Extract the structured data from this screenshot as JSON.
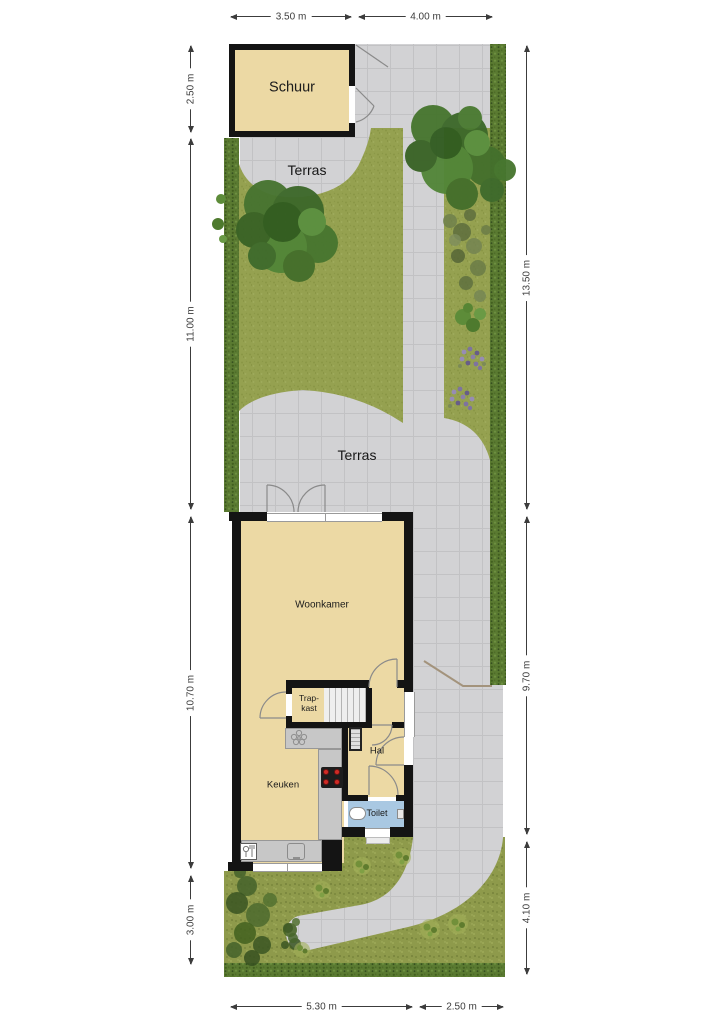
{
  "plan": {
    "labels": {
      "schuur": "Schuur",
      "terras_top": "Terras",
      "terras_mid": "Terras",
      "woonkamer": "Woonkamer",
      "trapkast_line1": "Trap-",
      "trapkast_line2": "kast",
      "keuken": "Keuken",
      "hal": "Hal",
      "toilet": "Toilet"
    },
    "dimensions": {
      "top": [
        "3.50 m",
        "4.00 m"
      ],
      "left": [
        "2.50 m",
        "11.00 m",
        "10.70 m",
        "3.00 m"
      ],
      "right": [
        "13.50 m",
        "9.70 m",
        "4.10 m"
      ],
      "bottom": [
        "5.30 m",
        "2.50 m"
      ]
    },
    "colors": {
      "floor": "#ecd9a4",
      "wall": "#141414",
      "paving": "#d2d2d4",
      "lawn": "#95a150",
      "hedge": "#5a7a31",
      "toilet_floor": "#a9c8e2",
      "counter": "#c7c7c7",
      "burner": "#cf2b26"
    }
  }
}
